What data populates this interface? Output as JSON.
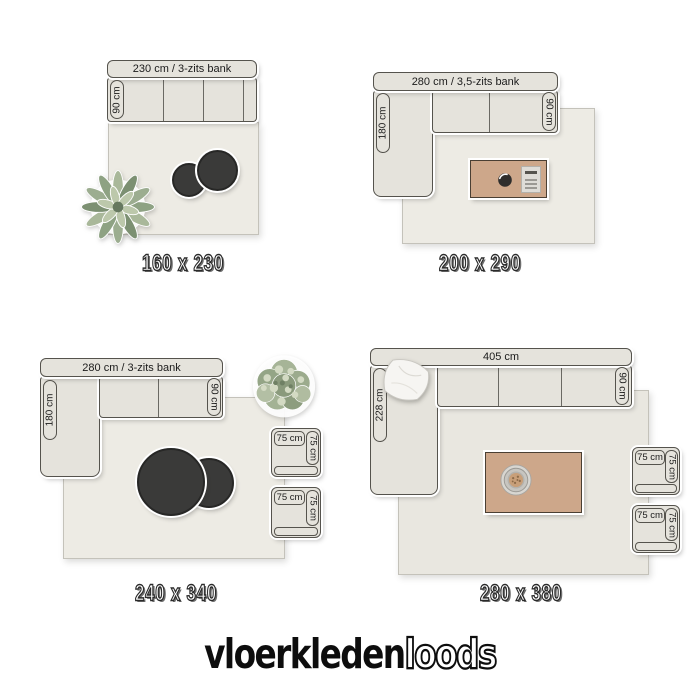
{
  "colors": {
    "page_bg": "#ffffff",
    "sofa_fill": "#e5e3dc",
    "sofa_border": "#55534d",
    "rug_fill": "#edebe4",
    "rug_fill_dark": "#e9e7e0",
    "wood_fill": "#cda78a",
    "wood_border": "#4a3f33",
    "round_table_fill": "#3a3a39",
    "round_table_border": "#272726",
    "label_text": "#1b1b1b",
    "logo_color": "#0d0d0d"
  },
  "logo": {
    "solid": "vloerkleden",
    "outline": "loods"
  },
  "rooms": [
    {
      "name": "rug-160x230",
      "caption": "160 x 230",
      "sofa_label": "230 cm / 3-zits bank",
      "sofa_depth": "90 cm"
    },
    {
      "name": "rug-200x290",
      "caption": "200 x 290",
      "sofa_label": "280 cm / 3,5-zits bank",
      "sofa_depth": "90 cm",
      "chaise_depth": "180 cm"
    },
    {
      "name": "rug-240x340",
      "caption": "240 x 340",
      "sofa_label": "280 cm / 3-zits bank",
      "sofa_depth": "90 cm",
      "chaise_depth": "180 cm",
      "armchairs": [
        {
          "w": "75 cm",
          "d": "75 cm"
        },
        {
          "w": "75 cm",
          "d": "75 cm"
        }
      ]
    },
    {
      "name": "rug-280x380",
      "caption": "280 x 380",
      "sofa_label": "405 cm",
      "sofa_depth": "90 cm",
      "chaise_depth": "228 cm",
      "armchairs": [
        {
          "w": "75 cm",
          "d": "75 cm"
        },
        {
          "w": "75 cm",
          "d": "75 cm"
        }
      ]
    }
  ]
}
